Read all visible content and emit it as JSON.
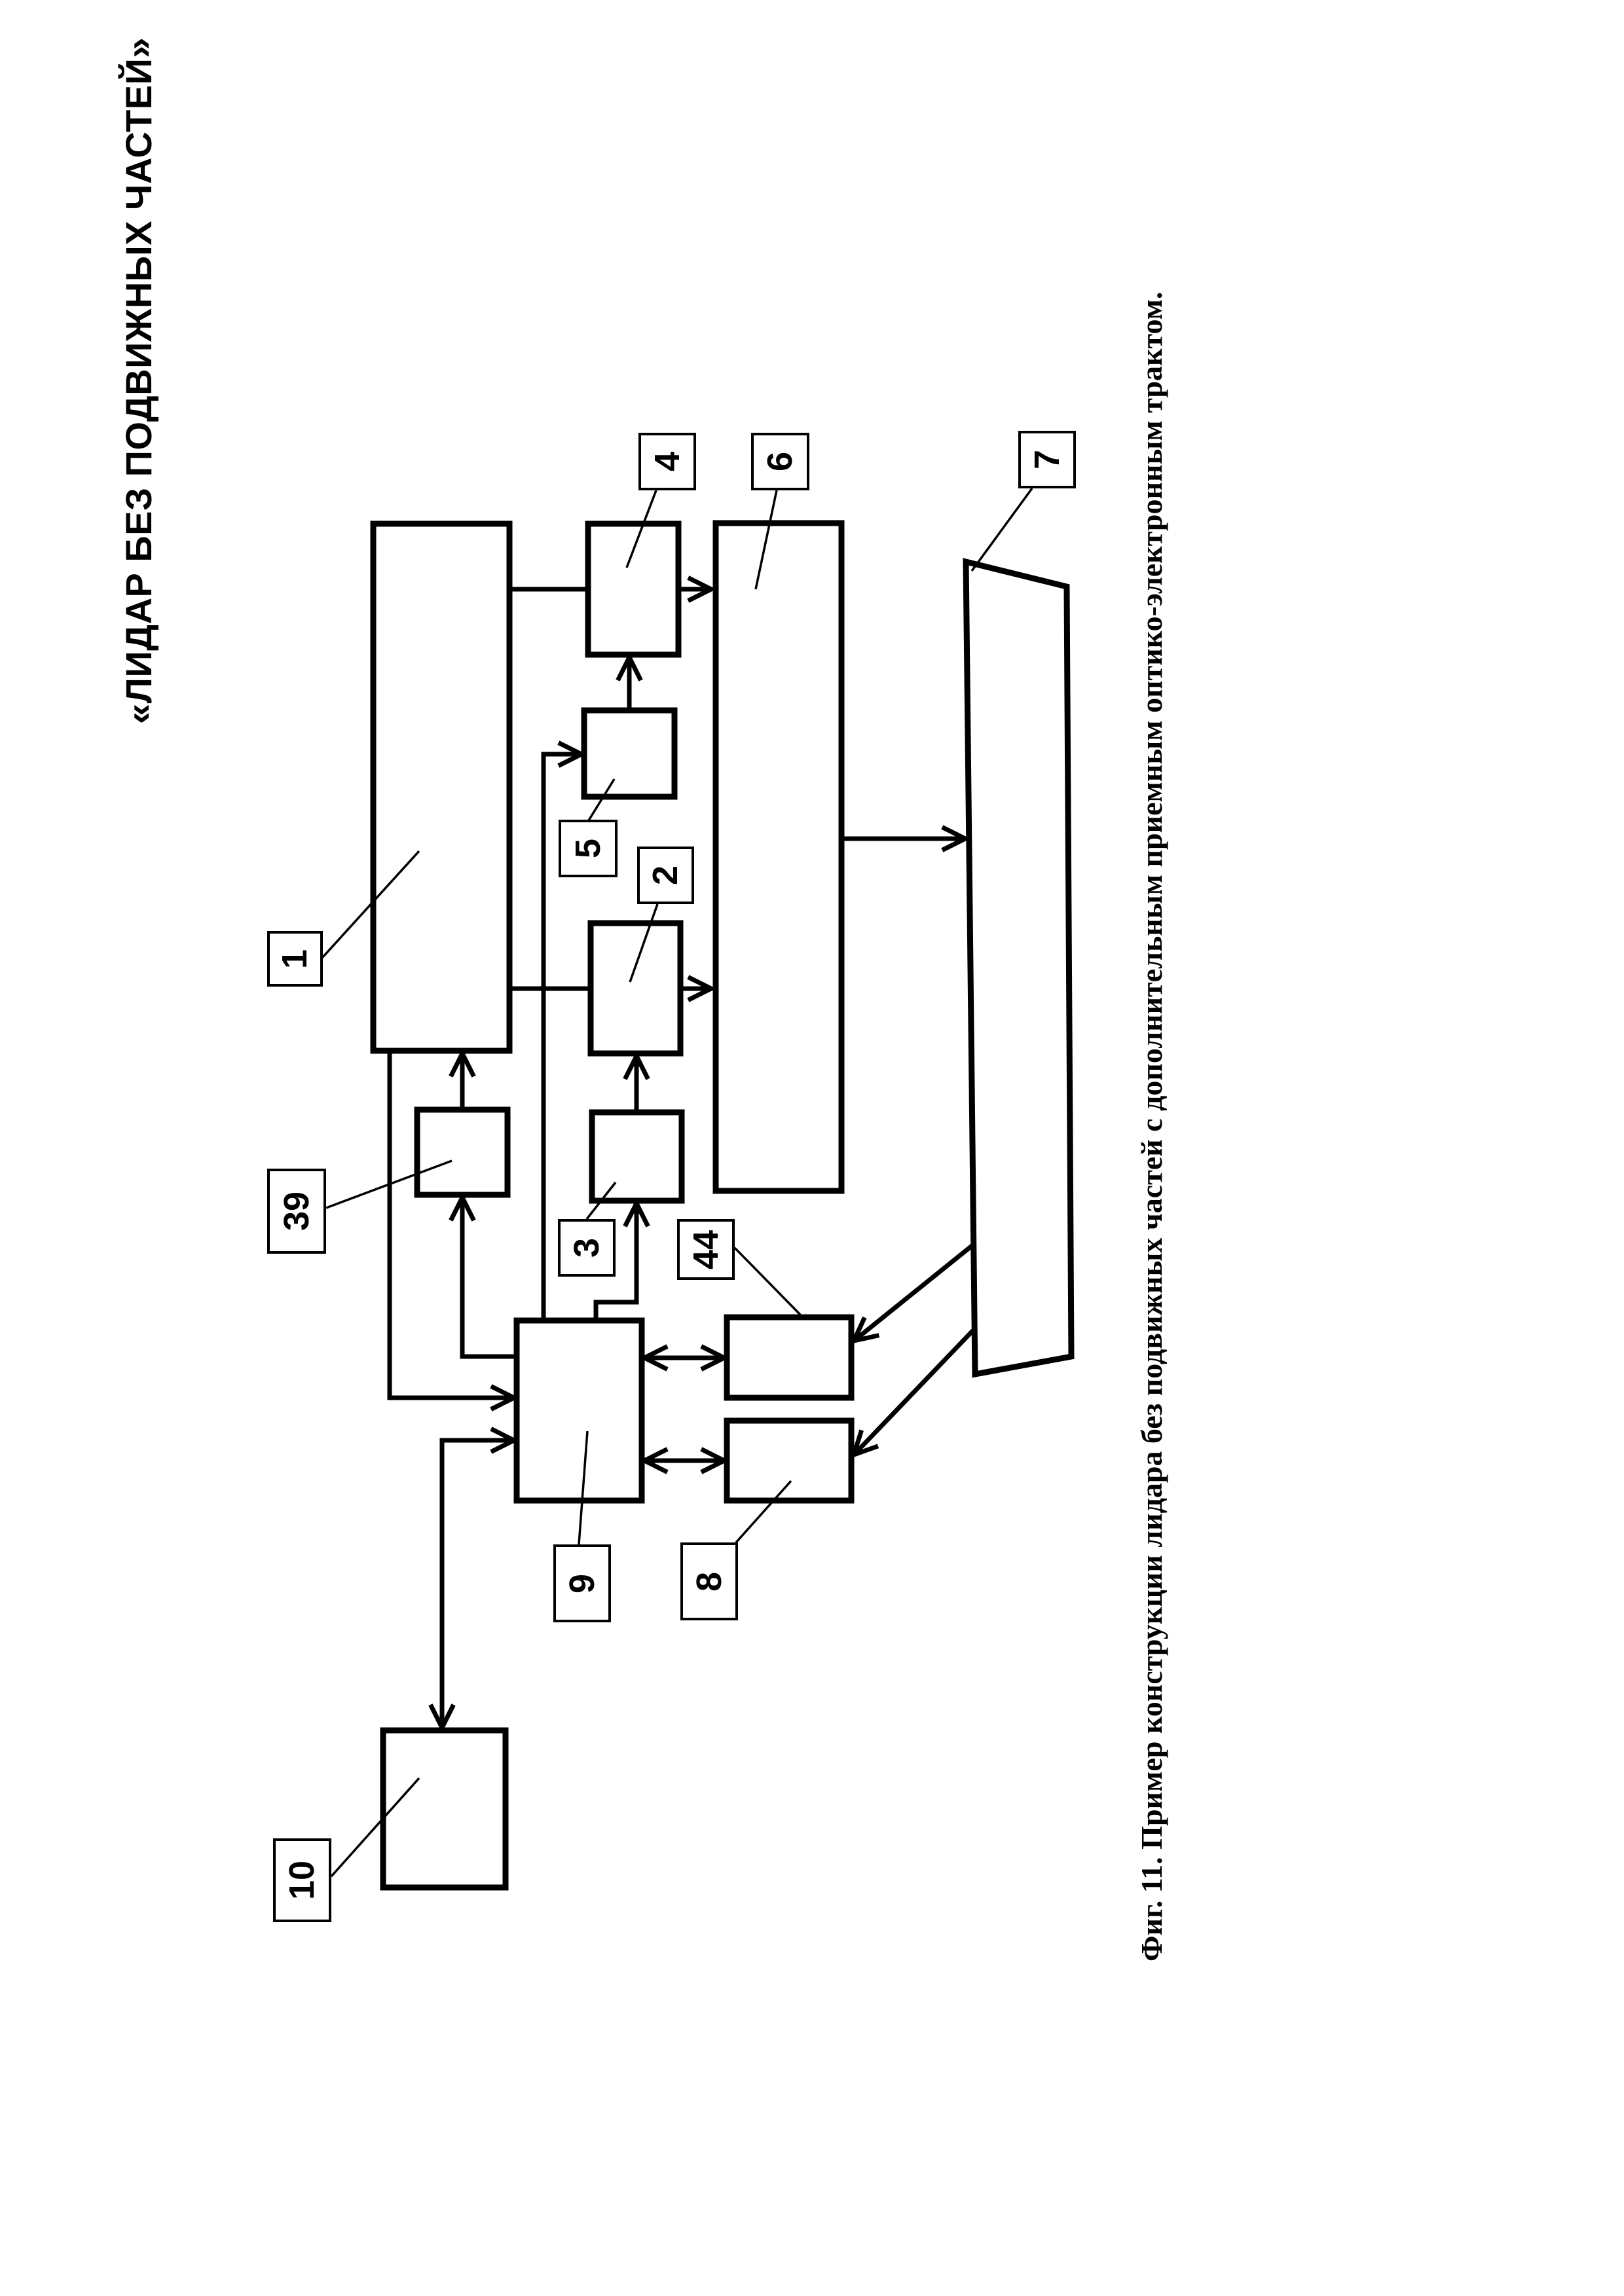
{
  "page": {
    "title": "«ЛИДАР БЕЗ ПОДВИЖНЫХ ЧАСТЕЙ»",
    "caption": "Фиг. 11. Пример конструкции лидара без подвижных частей с дополнительным приемным оптико-электронным трактом.",
    "ink_color": "#000000",
    "paper_color": "#ffffff"
  },
  "diagram": {
    "type": "patent-block-diagram",
    "orientation": "rotated-90-ccw",
    "blocks": [
      {
        "number": "1",
        "shape": "rect"
      },
      {
        "number": "4",
        "shape": "rect"
      },
      {
        "number": "5",
        "shape": "rect"
      },
      {
        "number": "2",
        "shape": "rect"
      },
      {
        "number": "3",
        "shape": "rect"
      },
      {
        "number": "39",
        "shape": "rect"
      },
      {
        "number": "6",
        "shape": "rect"
      },
      {
        "number": "7",
        "shape": "prism"
      },
      {
        "number": "9",
        "shape": "rect"
      },
      {
        "number": "44",
        "shape": "rect"
      },
      {
        "number": "8",
        "shape": "rect"
      },
      {
        "number": "10",
        "shape": "rect"
      }
    ],
    "edges": [
      {
        "from": "1",
        "to": "4",
        "arrow": "none"
      },
      {
        "from": "4",
        "to": "6",
        "arrow": "end"
      },
      {
        "from": "5",
        "to": "4",
        "arrow": "end"
      },
      {
        "from": "1",
        "to": "2",
        "arrow": "none"
      },
      {
        "from": "2",
        "to": "6",
        "arrow": "end"
      },
      {
        "from": "3",
        "to": "2",
        "arrow": "end"
      },
      {
        "from": "39",
        "to": "1",
        "arrow": "end"
      },
      {
        "from": "9",
        "to": "39",
        "arrow": "end"
      },
      {
        "from": "1",
        "to": "9",
        "arrow": "end"
      },
      {
        "from": "9",
        "to": "10",
        "arrow": "both"
      },
      {
        "from": "9",
        "to": "5",
        "arrow": "end"
      },
      {
        "from": "9",
        "to": "3",
        "arrow": "end"
      },
      {
        "from": "6",
        "to": "7",
        "arrow": "end"
      },
      {
        "from": "7",
        "to": "44",
        "arrow": "end"
      },
      {
        "from": "7",
        "to": "8",
        "arrow": "end"
      },
      {
        "from": "9",
        "to": "44",
        "arrow": "both"
      },
      {
        "from": "9",
        "to": "8",
        "arrow": "both"
      }
    ]
  }
}
